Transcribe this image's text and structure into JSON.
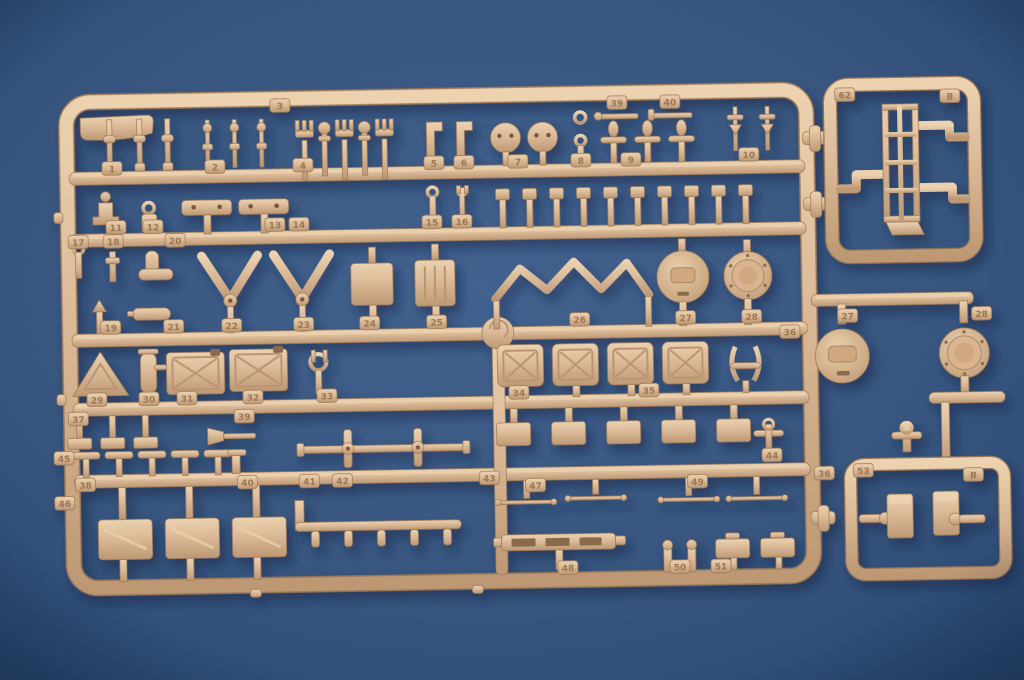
{
  "scene": {
    "description": "Photograph of a tan injection-molded plastic model kit sprue (parts tree, sprue letter B) lying on a blue background. A large rectangular runner frame holds rows of small parts: pegs, forks, round hatches, ribbed wheels, V-shaped tow arms, jerry cans, a warning triangle, fire extinguisher, tools, thin wire rods, strips and knobs. To its right are a small frame containing a ladder part (tabs 62 / B) and another small frame with two block parts (tabs 53 / B), plus two large round hatch/wheel parts labelled 27 and 28.",
    "subject": "model-kit sprue photo",
    "sprue_letter": "B",
    "part_numbers_visible": "1-51, 53, 62"
  },
  "colors": {
    "background_center": "#40608c",
    "background_edge": "#2a4871",
    "plastic_light": "#eed4b0",
    "plastic_mid": "#d9b795",
    "plastic_dark": "#b18c68",
    "plastic_outline": "#9a7757",
    "shadow": "#10233f"
  },
  "tabs": [
    {
      "x": 115,
      "y": 163,
      "t": "1"
    },
    {
      "x": 218,
      "y": 163,
      "t": "2"
    },
    {
      "x": 284,
      "y": 103,
      "t": "3"
    },
    {
      "x": 306,
      "y": 163,
      "t": "4"
    },
    {
      "x": 437,
      "y": 163,
      "t": "5"
    },
    {
      "x": 467,
      "y": 163,
      "t": "6"
    },
    {
      "x": 521,
      "y": 163,
      "t": "7"
    },
    {
      "x": 584,
      "y": 163,
      "t": "8"
    },
    {
      "x": 634,
      "y": 163,
      "t": "9"
    },
    {
      "x": 752,
      "y": 160,
      "t": "10"
    },
    {
      "x": 621,
      "y": 106,
      "t": "39"
    },
    {
      "x": 674,
      "y": 106,
      "t": "40"
    },
    {
      "x": 118,
      "y": 222,
      "t": "11"
    },
    {
      "x": 155,
      "y": 222,
      "t": "12"
    },
    {
      "x": 277,
      "y": 222,
      "t": "13"
    },
    {
      "x": 301,
      "y": 222,
      "t": "14"
    },
    {
      "x": 434,
      "y": 222,
      "t": "15"
    },
    {
      "x": 464,
      "y": 222,
      "t": "16"
    },
    {
      "x": 80,
      "y": 236,
      "t": "17"
    },
    {
      "x": 115,
      "y": 236,
      "t": "18"
    },
    {
      "x": 177,
      "y": 236,
      "t": "20"
    },
    {
      "x": 111,
      "y": 322,
      "t": "19"
    },
    {
      "x": 174,
      "y": 322,
      "t": "21"
    },
    {
      "x": 232,
      "y": 322,
      "t": "22"
    },
    {
      "x": 304,
      "y": 322,
      "t": "23"
    },
    {
      "x": 370,
      "y": 322,
      "t": "24"
    },
    {
      "x": 437,
      "y": 322,
      "t": "25"
    },
    {
      "x": 580,
      "y": 322,
      "t": "26"
    },
    {
      "x": 686,
      "y": 322,
      "t": "27"
    },
    {
      "x": 752,
      "y": 322,
      "t": "28"
    },
    {
      "x": 96,
      "y": 394,
      "t": "29"
    },
    {
      "x": 148,
      "y": 394,
      "t": "30"
    },
    {
      "x": 186,
      "y": 394,
      "t": "31"
    },
    {
      "x": 252,
      "y": 394,
      "t": "32"
    },
    {
      "x": 326,
      "y": 394,
      "t": "33"
    },
    {
      "x": 518,
      "y": 394,
      "t": "34"
    },
    {
      "x": 648,
      "y": 394,
      "t": "35"
    },
    {
      "x": 77,
      "y": 413,
      "t": "37"
    },
    {
      "x": 243,
      "y": 413,
      "t": "39"
    },
    {
      "x": 83,
      "y": 479,
      "t": "38"
    },
    {
      "x": 245,
      "y": 479,
      "t": "40"
    },
    {
      "x": 307,
      "y": 479,
      "t": "41"
    },
    {
      "x": 340,
      "y": 479,
      "t": "42"
    },
    {
      "x": 487,
      "y": 479,
      "t": "43"
    },
    {
      "x": 770,
      "y": 461,
      "t": "44"
    },
    {
      "x": 62,
      "y": 452,
      "t": "45"
    },
    {
      "x": 62,
      "y": 497,
      "t": "46"
    },
    {
      "x": 533,
      "y": 487,
      "t": "47"
    },
    {
      "x": 695,
      "y": 486,
      "t": "49"
    },
    {
      "x": 564,
      "y": 570,
      "t": "48"
    },
    {
      "x": 676,
      "y": 571,
      "t": "50"
    },
    {
      "x": 717,
      "y": 571,
      "t": "51"
    },
    {
      "x": 790,
      "y": 338,
      "t": "36"
    },
    {
      "x": 822,
      "y": 480,
      "t": "36"
    },
    {
      "x": 848,
      "y": 323,
      "t": "27"
    },
    {
      "x": 982,
      "y": 323,
      "t": "28"
    },
    {
      "x": 849,
      "y": 102,
      "t": "62"
    },
    {
      "x": 954,
      "y": 105,
      "t": "B"
    },
    {
      "x": 861,
      "y": 478,
      "t": "53"
    },
    {
      "x": 971,
      "y": 484,
      "t": "B"
    }
  ],
  "frames": {
    "main": {
      "rows_of_parts": 6,
      "content": "numbered small parts 1-51"
    },
    "top_right": {
      "corner_tabs": [
        "62",
        "B"
      ],
      "content": "ladder part"
    },
    "bottom_right": {
      "corner_tabs": [
        "53",
        "B"
      ],
      "content": "two block parts"
    }
  }
}
